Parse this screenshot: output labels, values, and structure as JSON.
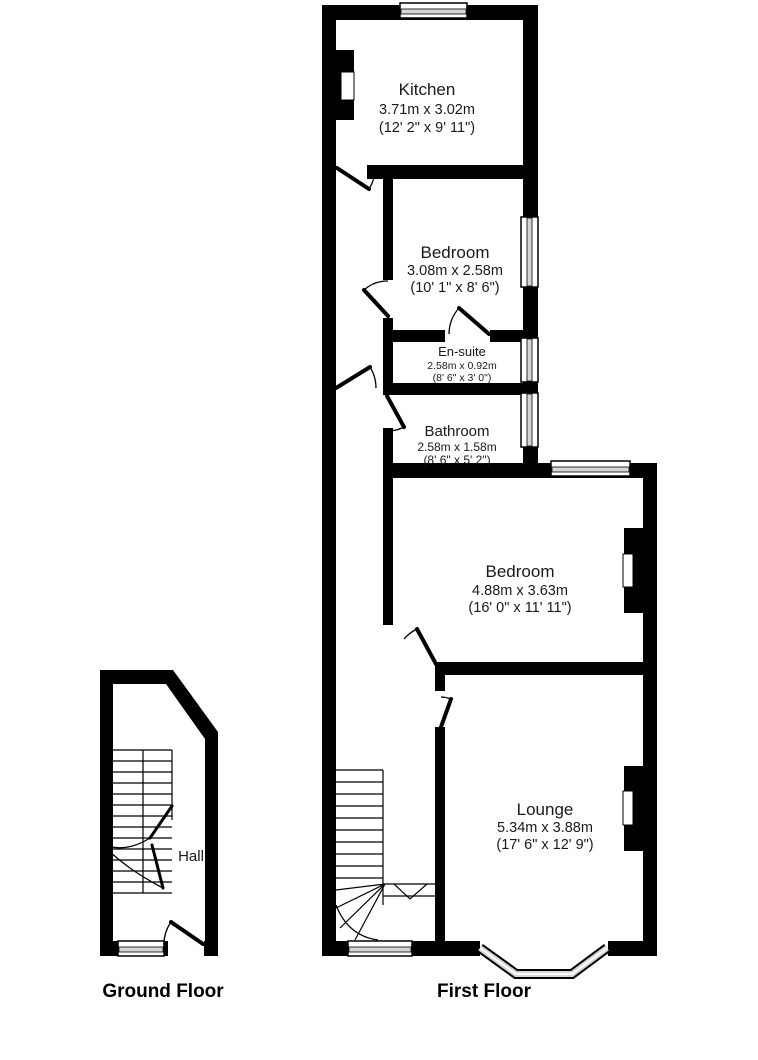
{
  "title": "Floor plan",
  "colors": {
    "wall": "#000000",
    "background": "#ffffff",
    "glass": "#d6d6d6",
    "text": "#1a1a1a"
  },
  "ground_floor": {
    "label": "Ground Floor",
    "rooms": {
      "hall": {
        "name": "Hall"
      }
    }
  },
  "first_floor": {
    "label": "First Floor",
    "rooms": {
      "kitchen": {
        "name": "Kitchen",
        "metric": "3.71m x 3.02m",
        "imperial": "(12' 2\" x 9' 11\")"
      },
      "bedroom_small": {
        "name": "Bedroom",
        "metric": "3.08m x 2.58m",
        "imperial": "(10' 1\" x 8' 6\")"
      },
      "ensuite": {
        "name": "En-suite",
        "metric": "2.58m x 0.92m",
        "imperial": "(8' 6\" x 3' 0\")"
      },
      "bathroom": {
        "name": "Bathroom",
        "metric": "2.58m x 1.58m",
        "imperial": "(8' 6\" x 5' 2\")"
      },
      "bedroom_large": {
        "name": "Bedroom",
        "metric": "4.88m x 3.63m",
        "imperial": "(16' 0\" x 11' 11\")"
      },
      "lounge": {
        "name": "Lounge",
        "metric": "5.34m x 3.88m",
        "imperial": "(17' 6\" x 12' 9\")"
      }
    }
  }
}
